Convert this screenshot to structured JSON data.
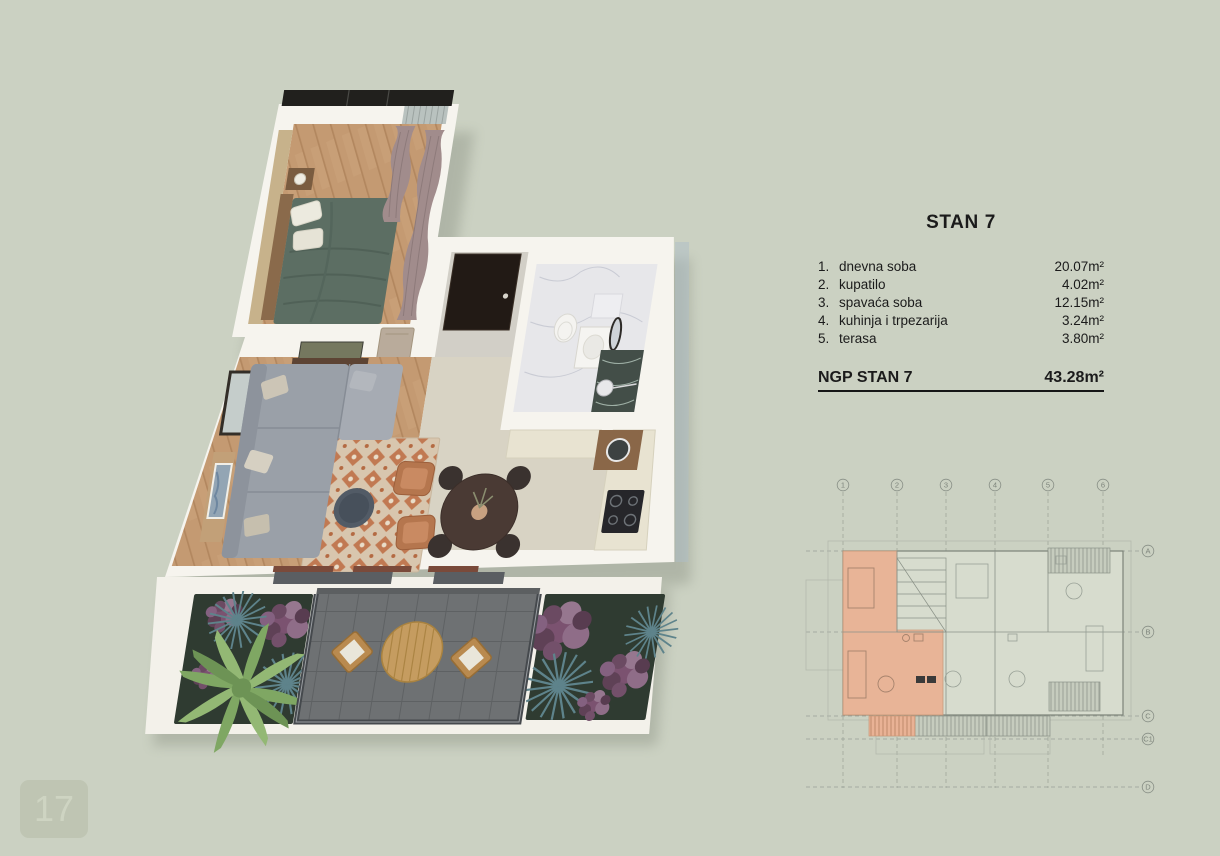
{
  "page": {
    "number": "17",
    "background_color": "#cbd1c2"
  },
  "area_table": {
    "title": "STAN 7",
    "rows": [
      {
        "num": "1.",
        "label": "dnevna soba",
        "value": "20.07m²"
      },
      {
        "num": "2.",
        "label": "kupatilo",
        "value": "4.02m²"
      },
      {
        "num": "3.",
        "label": "spavaća soba",
        "value": "12.15m²"
      },
      {
        "num": "4.",
        "label": "kuhinja i trpezarija",
        "value": "3.24m²"
      },
      {
        "num": "5.",
        "label": "terasa",
        "value": "3.80m²"
      }
    ],
    "total": {
      "label": "NGP STAN 7",
      "value": "43.28m²"
    }
  },
  "site_plan": {
    "column_labels": [
      "1",
      "2",
      "3",
      "4",
      "5",
      "6"
    ],
    "row_labels": [
      "A",
      "B",
      "C",
      "C1",
      "D"
    ],
    "highlight_color": "#e9b295"
  },
  "render3d": {
    "rooms": [
      "dnevna soba",
      "kupatilo",
      "spavaća soba",
      "kuhinja i trpezarija",
      "terasa"
    ],
    "colors": {
      "wall": "#f6f4ee",
      "wood_floor": "#c49a72",
      "bed": "#5c6e63",
      "sofa": "#9aa0a8",
      "rug": "#c2764a",
      "armchair": "#b5764e",
      "terrace_deck": "#6e7173",
      "plant_green": "#86a96b",
      "plant_purple": "#7e5570",
      "marble": "#e7e7ea",
      "entrance_door": "#221a15"
    }
  }
}
